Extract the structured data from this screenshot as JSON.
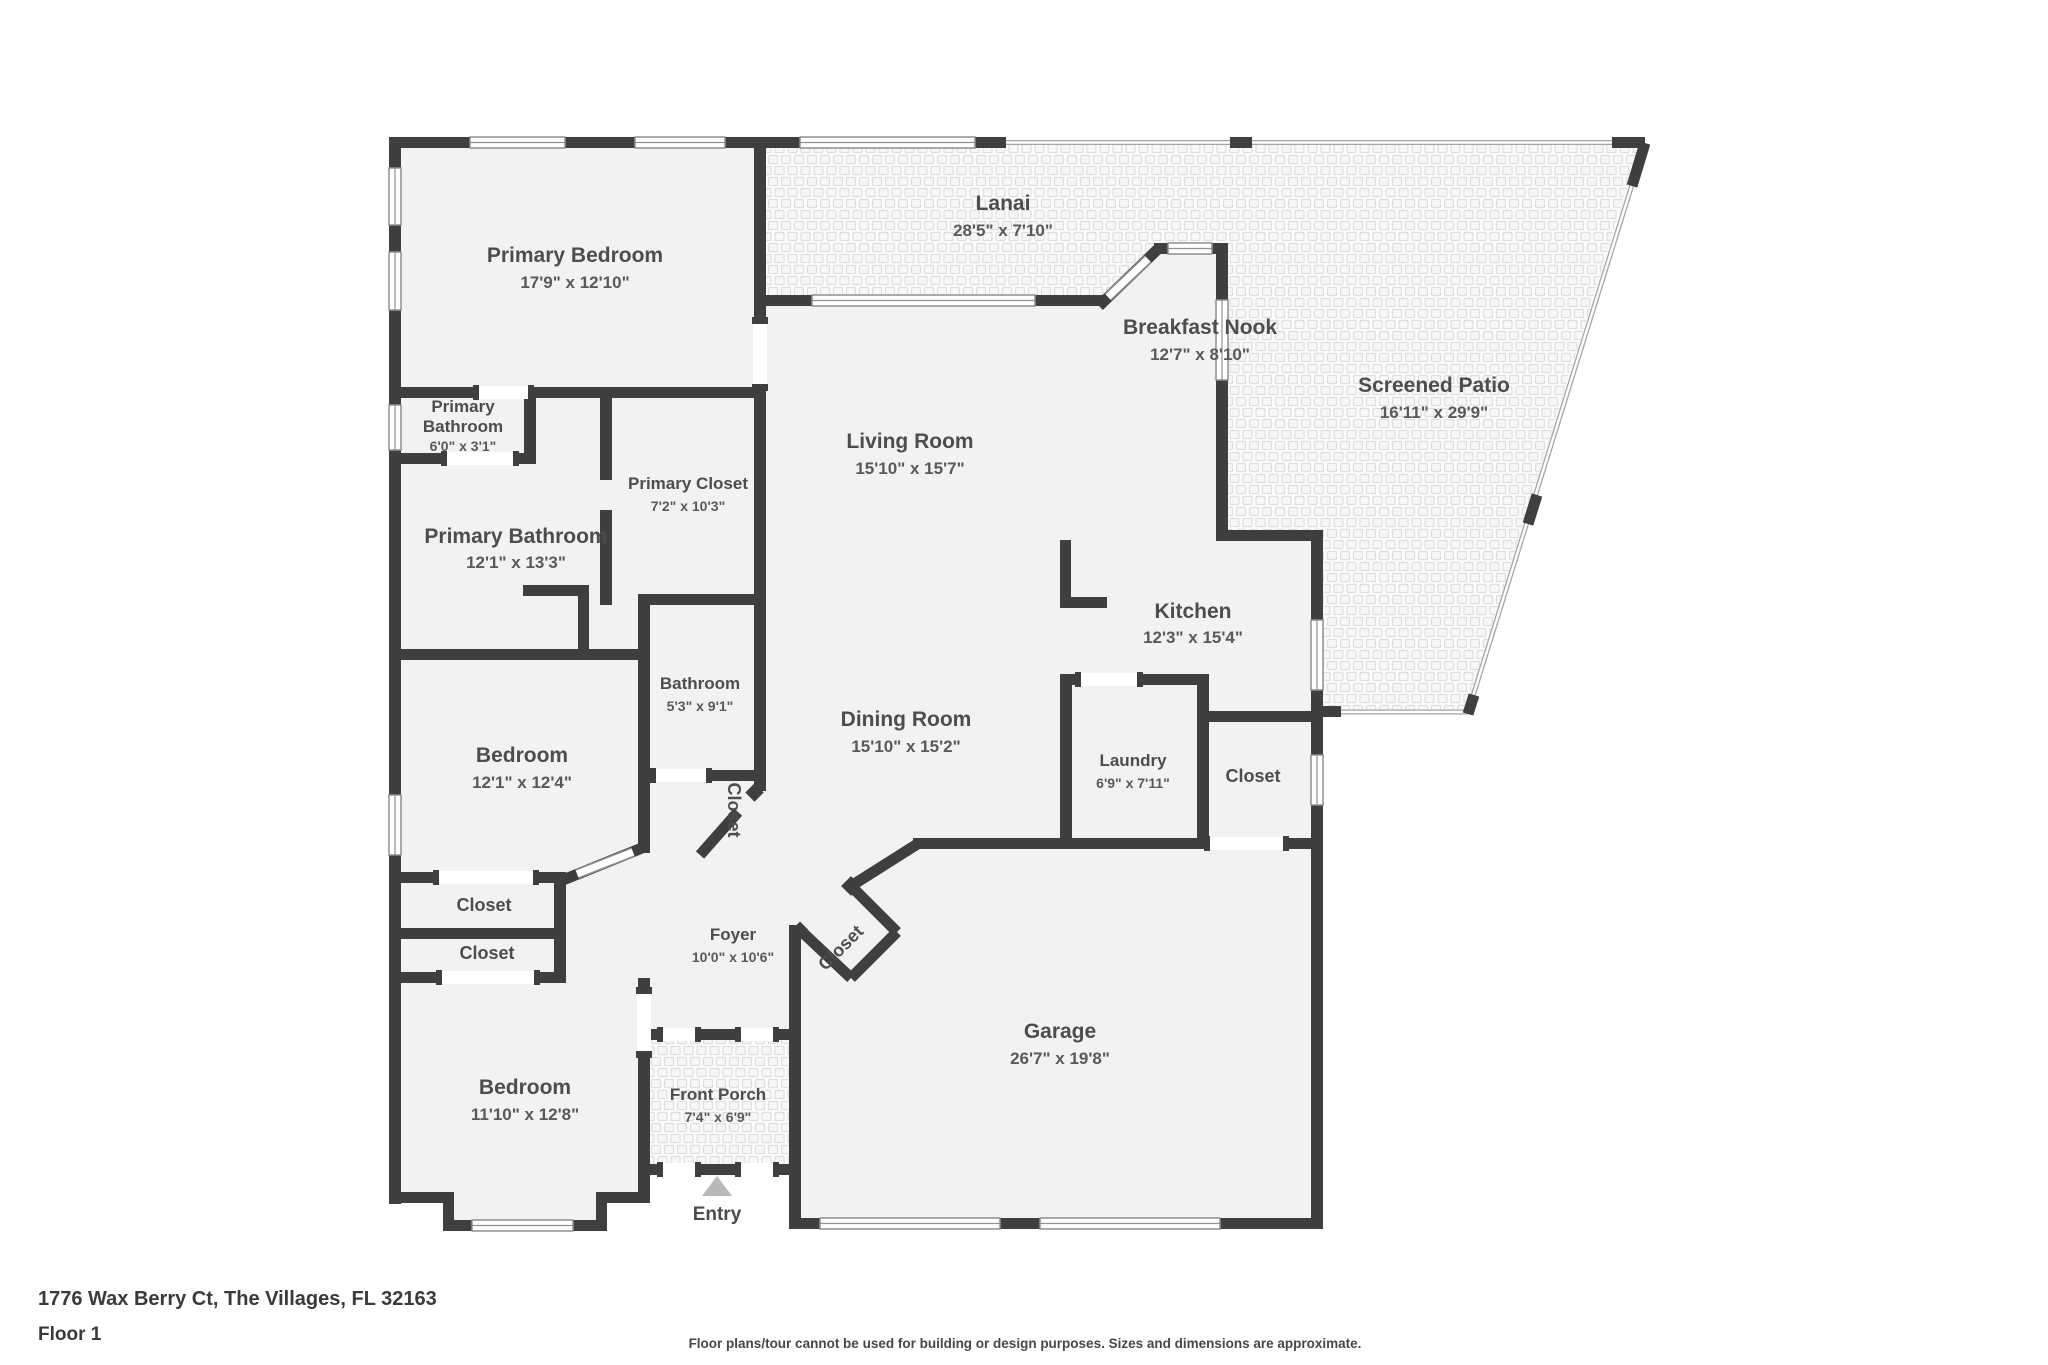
{
  "footer": {
    "address": "1776 Wax Berry Ct, The Villages, FL 32163",
    "floor_label": "Floor 1",
    "disclaimer": "Floor plans/tour cannot be used for building or design purposes. Sizes and dimensions are approximate."
  },
  "entry_label": "Entry",
  "colors": {
    "wall": "#3f3f3f",
    "room_fill": "#f2f2f2",
    "hatch_line": "#dedede",
    "label_text": "#4d4d4d",
    "entry_arrow": "#b9b9b9"
  },
  "rooms": {
    "primary_bedroom": {
      "name": "Primary Bedroom",
      "dims": "17'9\" x 12'10\""
    },
    "lanai": {
      "name": "Lanai",
      "dims": "28'5\" x 7'10\""
    },
    "breakfast_nook": {
      "name": "Breakfast Nook",
      "dims": "12'7\" x 8'10\""
    },
    "screened_patio": {
      "name": "Screened Patio",
      "dims": "16'11\" x 29'9\""
    },
    "primary_bathroom_small": {
      "name_line1": "Primary",
      "name_line2": "Bathroom",
      "dims": "6'0\" x 3'1\""
    },
    "primary_closet": {
      "name": "Primary Closet",
      "dims": "7'2\" x 10'3\""
    },
    "primary_bathroom": {
      "name": "Primary Bathroom",
      "dims": "12'1\" x 13'3\""
    },
    "living_room": {
      "name": "Living Room",
      "dims": "15'10\" x 15'7\""
    },
    "kitchen": {
      "name": "Kitchen",
      "dims": "12'3\" x 15'4\""
    },
    "bathroom": {
      "name": "Bathroom",
      "dims": "5'3\" x 9'1\""
    },
    "dining_room": {
      "name": "Dining Room",
      "dims": "15'10\" x 15'2\""
    },
    "laundry": {
      "name": "Laundry",
      "dims": "6'9\" x 7'11\""
    },
    "closet_laundry": {
      "name": "Closet"
    },
    "bedroom_middle": {
      "name": "Bedroom",
      "dims": "12'1\" x 12'4\""
    },
    "closet_hall": {
      "name": "Closet"
    },
    "closet_a": {
      "name": "Closet"
    },
    "closet_b": {
      "name": "Closet"
    },
    "foyer": {
      "name": "Foyer",
      "dims": "10'0\" x 10'6\""
    },
    "closet_foyer": {
      "name": "Closet"
    },
    "garage": {
      "name": "Garage",
      "dims": "26'7\" x 19'8\""
    },
    "bedroom_front": {
      "name": "Bedroom",
      "dims": "11'10\" x 12'8\""
    },
    "front_porch": {
      "name": "Front Porch",
      "dims": "7'4\" x 6'9\""
    }
  }
}
